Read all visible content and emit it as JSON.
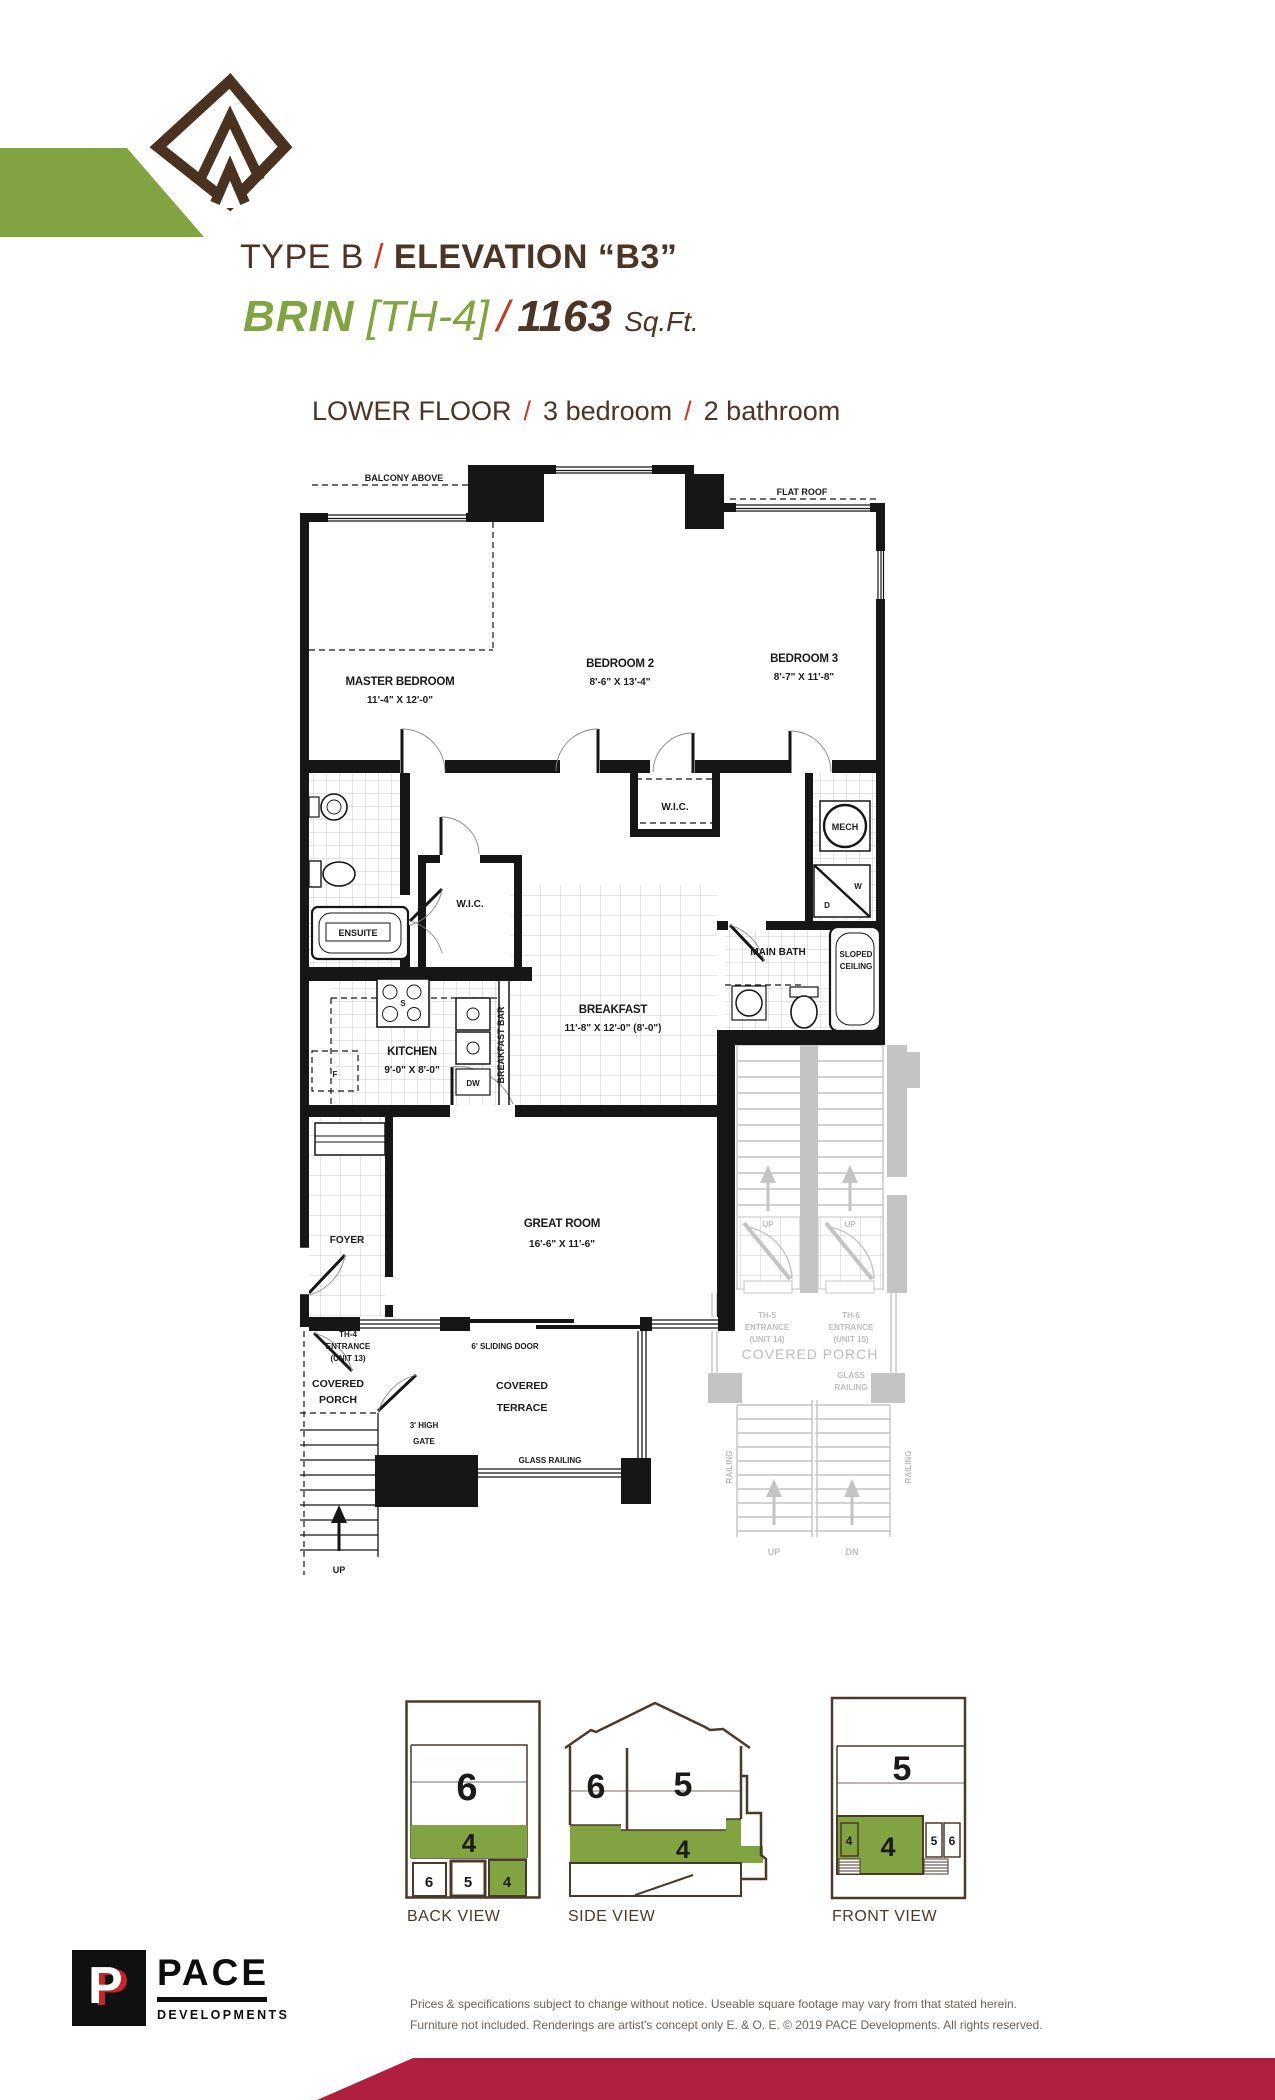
{
  "colors": {
    "green": "#82a342",
    "brown": "#4b3526",
    "red": "#c0392b",
    "maroon": "#b01f3e",
    "neighbor_gray": "#c4c4c4"
  },
  "header": {
    "type_label": "TYPE B",
    "slash": "/",
    "elevation_label": "ELEVATION “B3”",
    "model": "BRIN",
    "unit_label": "[TH-4]",
    "sqft_value": "1163",
    "sqft_unit": "Sq.Ft.",
    "floor_label": "LOWER FLOOR",
    "bedrooms": "3 bedroom",
    "bathrooms": "2 bathroom"
  },
  "plan": {
    "balcony": "BALCONY ABOVE",
    "flat_roof": "FLAT ROOF",
    "master": {
      "name": "MASTER BEDROOM",
      "dims": "11'-4\" X 12'-0\""
    },
    "bedroom2": {
      "name": "BEDROOM 2",
      "dims": "8'-6\" X 13'-4\""
    },
    "bedroom3": {
      "name": "BEDROOM 3",
      "dims": "8'-7\" X 11'-8\""
    },
    "wic": "W.I.C.",
    "wic2": "W.I.C.",
    "ensuite": "ENSUITE",
    "mech": "MECH",
    "washer": "W",
    "dryer": "D",
    "stove": "S",
    "fridge": "F",
    "dishwasher": "DW",
    "breakfast": {
      "name": "BREAKFAST",
      "dims": "11'-8\" X 12'-0\" (8'-0\")"
    },
    "breakfast_bar": "BREAKFAST BAR",
    "kitchen": {
      "name": "KITCHEN",
      "dims": "9'-0\" X 8'-0\""
    },
    "main_bath": "MAIN BATH",
    "sloped": "SLOPED",
    "ceiling": "CEILING",
    "great_room": {
      "name": "GREAT ROOM",
      "dims": "16'-6\" X 11'-6\""
    },
    "foyer": "FOYER",
    "th4": [
      "TH-4",
      "ENTRANCE",
      "(UNIT 13)"
    ],
    "covered": "COVERED",
    "porch": "PORCH",
    "sliding_door": "6' SLIDING DOOR",
    "terrace_l1": "COVERED",
    "terrace_l2": "TERRACE",
    "gate_l1": "3' HIGH",
    "gate_l2": "GATE",
    "glass_railing": "GLASS RAILING",
    "up": "UP",
    "neighbor": {
      "th5": [
        "TH-5",
        "ENTRANCE",
        "(UNIT 14)"
      ],
      "th6": [
        "TH-6",
        "ENTRANCE",
        "(UNIT 15)"
      ],
      "covered_porch": "COVERED PORCH",
      "glass": "GLASS",
      "railing": "RAILING",
      "railing_side": "RAILING",
      "up": "UP",
      "dn": "DN"
    }
  },
  "views": {
    "back": {
      "label": "BACK VIEW",
      "upper": "6",
      "band": "4",
      "cells": [
        "6",
        "5",
        "4"
      ]
    },
    "side": {
      "label": "SIDE VIEW",
      "left": "6",
      "right": "5",
      "band": "4"
    },
    "front": {
      "label": "FRONT VIEW",
      "upper": "5",
      "band": "4",
      "cell_left": "4",
      "cells": [
        "5",
        "6"
      ]
    }
  },
  "footer": {
    "logo_initial": "P",
    "logo_name": "PACE",
    "logo_sub": "DEVELOPMENTS",
    "disclaimer1": "Prices & specifications subject to change without notice. Useable square footage may vary from that stated herein.",
    "disclaimer2": "Furniture not included. Renderings are artist's concept only E. & O. E. © 2019 PACE Developments. All rights reserved."
  }
}
